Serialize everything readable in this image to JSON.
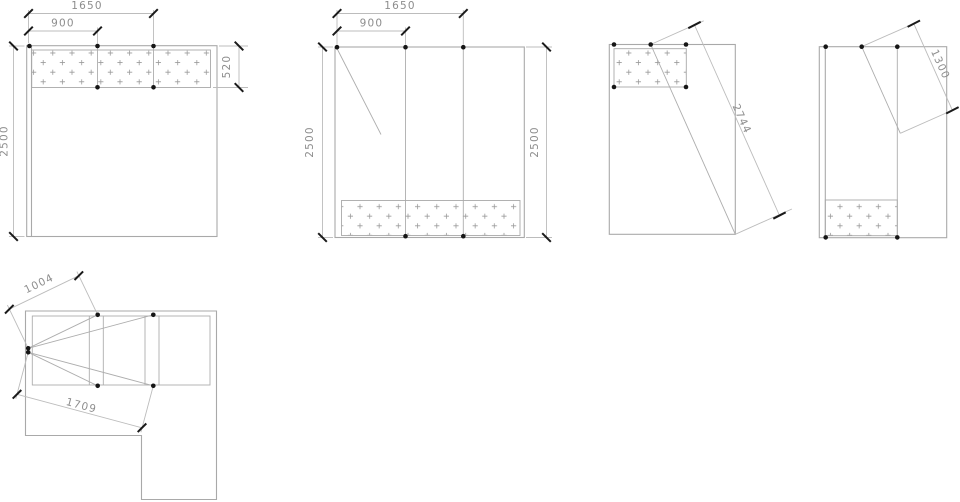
{
  "dimensions": {
    "panel1": {
      "width_total": "1650",
      "width_left": "900",
      "height": "2500",
      "band_height": "520"
    },
    "panel2": {
      "width_total": "1650",
      "width_left": "900",
      "height_left": "2500",
      "height_right": "2500"
    },
    "panel3": {
      "diagonal": "2744"
    },
    "panel4": {
      "diagonal": "1300"
    },
    "plan": {
      "upper_diagonal": "1004",
      "lower_diagonal": "1709"
    }
  }
}
